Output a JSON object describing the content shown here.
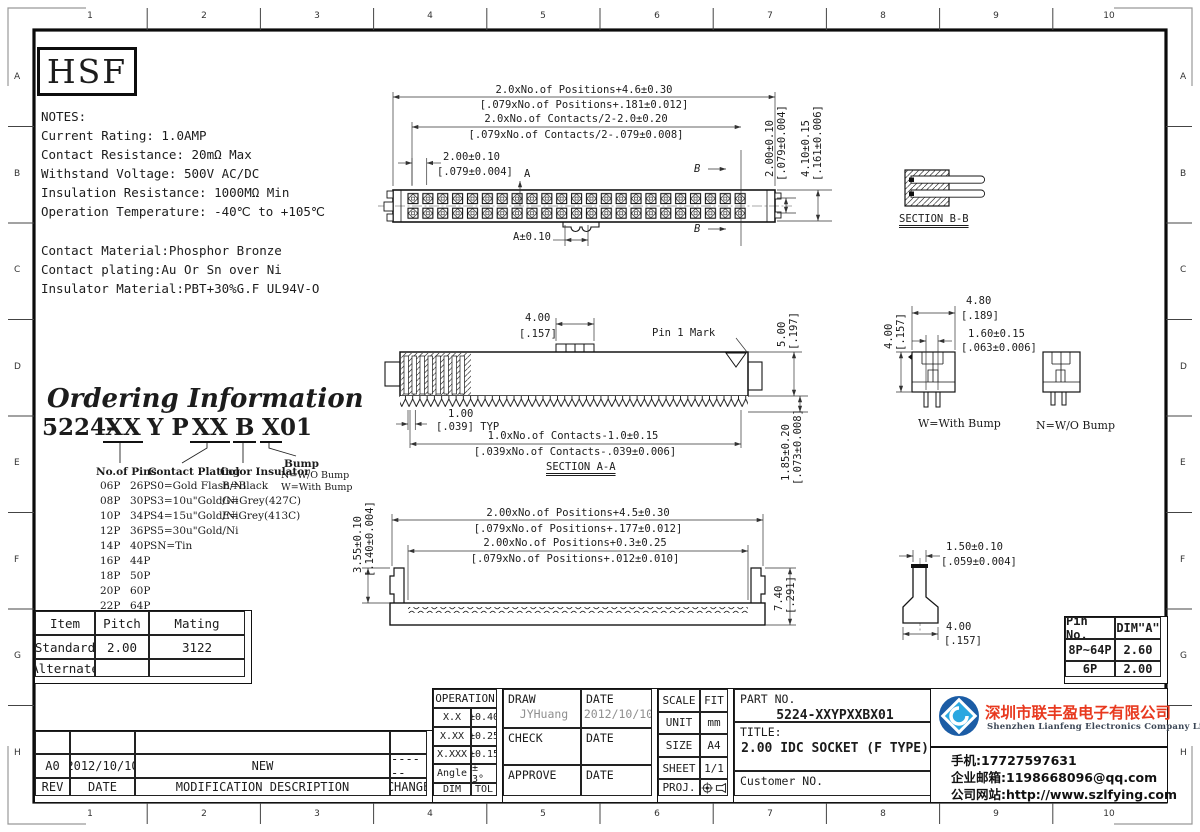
{
  "sheet": {
    "ruler_cols": [
      "1",
      "2",
      "3",
      "4",
      "5",
      "6",
      "7",
      "8",
      "9",
      "10"
    ],
    "ruler_rows": [
      "A",
      "B",
      "C",
      "D",
      "E",
      "F",
      "G",
      "H"
    ],
    "logo_text": "HSF"
  },
  "notes": {
    "heading": "NOTES:",
    "line1": "Current Rating: 1.0AMP",
    "line2": "Contact Resistance: 20mΩ Max",
    "line3": "Withstand Voltage: 500V AC/DC",
    "line4": "Insulation Resistance: 1000MΩ Min",
    "line5": "Operation Temperature: -40℃ to +105℃",
    "line6": "Contact Material:Phosphor Bronze",
    "line7": "Contact plating:Au Or Sn over Ni",
    "line8": "Insulator Material:PBT+30%G.F UL94V-O"
  },
  "top_view": {
    "dim_positions_mm": "2.0xNo.of Positions+4.6±0.30",
    "dim_positions_in": "[.079xNo.of Positions+.181±0.012]",
    "dim_contacts_mm": "2.0xNo.of Contacts/2-2.0±0.20",
    "dim_contacts_in": "[.079xNo.of Contacts/2-.079±0.008]",
    "dim_pitch_mm": "2.00±0.10",
    "dim_pitch_in": "[.079±0.004]",
    "dim_row_mm": "2.00±0.10",
    "dim_row_in": "[.079±0.004]",
    "dim_height_mm": "4.10±0.15",
    "dim_height_in": "[.161±0.006]",
    "label_a_top": "A",
    "label_a_bottom": "A±0.10",
    "label_b_top": "B",
    "label_b_bottom": "B"
  },
  "section_bb": {
    "label": "SECTION B-B"
  },
  "section_aa": {
    "dim_key_mm": "4.00",
    "dim_key_in": "[.157]",
    "pin1_label": "Pin 1 Mark",
    "dim_height_mm": "5.00",
    "dim_height_in": "[.197]",
    "dim_typ_mm": "1.00",
    "dim_typ_in": "[.039] TYP",
    "dim_contacts_mm": "1.0xNo.of Contacts-1.0±0.15",
    "dim_contacts_in": "[.039xNo.of Contacts-.039±0.006]",
    "label": "SECTION A-A",
    "dim_tail_mm": "1.85±0.20",
    "dim_tail_in": "[.073±0.008]"
  },
  "bump_views": {
    "dim_width_mm": "4.80",
    "dim_width_in": "[.189]",
    "dim_pin_mm": "1.60±0.15",
    "dim_pin_in": "[.063±0.006]",
    "dim_height_mm": "4.00",
    "dim_height_in": "[.157]",
    "with_bump_label": "W=With Bump",
    "without_bump_label": "N=W/O Bump"
  },
  "ordering": {
    "title": "Ordering Information",
    "code_prefix": "5224-",
    "code_pins": "XX",
    "code_mid": "Y P",
    "code_plating": "XX",
    "code_color": "B",
    "code_bump": "X",
    "code_suffix": "01",
    "pins_header": "No.of Pins",
    "pins_col1": [
      "06P",
      "08P",
      "10P",
      "12P",
      "14P",
      "16P",
      "18P",
      "20P",
      "22P",
      "24P"
    ],
    "pins_col2": [
      "26P",
      "30P",
      "34P",
      "36P",
      "40P",
      "44P",
      "50P",
      "60P",
      "64P"
    ],
    "plating_header": "Contact Plating",
    "plating": [
      "S0=Gold Flash/Ni",
      "S3=10u\"Gold/Ni",
      "S4=15u\"Gold/Ni",
      "S5=30u\"Gold/Ni",
      "SN=Tin"
    ],
    "color_header": "Color Insulator",
    "colors": [
      "B=Black",
      "G=Grey(427C)",
      "E=Grey(413C)"
    ],
    "bump_header": "Bump",
    "bumps": [
      "N=W/O Bump",
      "W=With Bump"
    ]
  },
  "bottom_view": {
    "dim_outer_mm": "2.00xNo.of Positions+4.5±0.30",
    "dim_outer_in": "[.079xNo.of Positions+.177±0.012]",
    "dim_inner_mm": "2.00xNo.of Positions+0.3±0.25",
    "dim_inner_in": "[.079xNo.of Positions+.012±0.010]",
    "dim_left_mm": "3.55±0.10",
    "dim_left_in": "[.140±0.004]",
    "dim_right_mm": "7.40",
    "dim_right_in": "[.291]"
  },
  "pin_detail": {
    "dim_top_mm": "1.50±0.10",
    "dim_top_in": "[.059±0.004]",
    "dim_bottom_mm": "4.00",
    "dim_bottom_in": "[.157]"
  },
  "mating_table": {
    "headers": [
      "Item",
      "Pitch",
      "Mating"
    ],
    "row1": [
      "Standard",
      "2.00",
      "3122"
    ],
    "row2": [
      "Alternate",
      "",
      ""
    ]
  },
  "pin_table": {
    "headers": [
      "Pin No.",
      "DIM\"A\""
    ],
    "row1": [
      "8P~64P",
      "2.60"
    ],
    "row2": [
      "6P",
      "2.00"
    ]
  },
  "revision": {
    "row": [
      "A0",
      "2012/10/10",
      "NEW",
      "------"
    ],
    "headers": [
      "REV",
      "DATE",
      "MODIFICATION DESCRIPTION",
      "CHANGE"
    ]
  },
  "tolerance": {
    "header": "OPERATION",
    "rows": [
      [
        "X.X",
        "±0.40"
      ],
      [
        "X.XX",
        "±0.25"
      ],
      [
        "X.XXX",
        "±0.15"
      ],
      [
        "Angle",
        "± 3°"
      ],
      [
        "DIM",
        "TOL"
      ]
    ]
  },
  "approval": {
    "draw_label": "DRAW",
    "draw_value": "JYHuang",
    "date_label": "DATE",
    "draw_date": "2012/10/10",
    "check_label": "CHECK",
    "approve_label": "APPROVE"
  },
  "info": {
    "scale_label": "SCALE",
    "scale": "FIT",
    "unit_label": "UNIT",
    "unit": "mm",
    "size_label": "SIZE",
    "size": "A4",
    "sheet_label": "SHEET",
    "sheet": "1/1",
    "proj_label": "PROJ."
  },
  "part": {
    "part_no_label": "PART NO.",
    "part_no": "5224-XXYPXXBX01",
    "title_label": "TITLE:",
    "title": "2.00 IDC SOCKET (F TYPE)",
    "customer_label": "Customer NO."
  },
  "company": {
    "name_cn": "深圳市联丰盈电子有限公司",
    "name_en": "Shenzhen Lianfeng Electronics Company Limited",
    "phone": "手机:17727597631",
    "email": "企业邮箱:1198668096@qq.com",
    "website": "公司网站:http://www.szlfying.com",
    "brand_red": "#e8391f",
    "logo_dark_blue": "#1b5ca5",
    "logo_light_blue": "#2aa7e0"
  }
}
